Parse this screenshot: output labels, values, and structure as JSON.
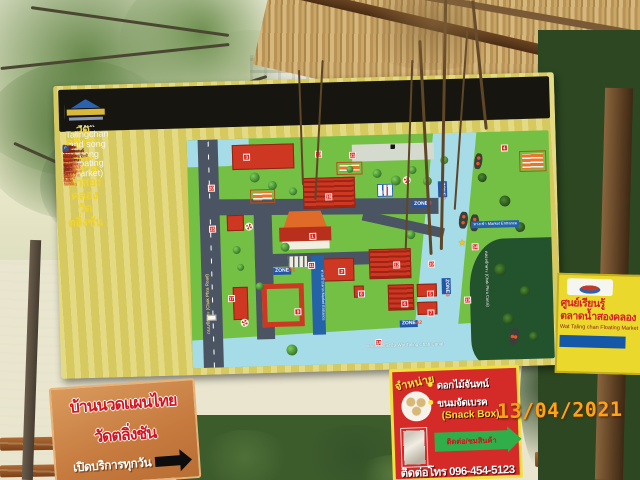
{
  "header": {
    "title_thai": "แผนผังวัดตลิ่งชัน และตลาดน้ำสองคลองวัดตลิ่งชัน",
    "title_en": "(Map of Wat Talingchan and song Klong Floating Market)"
  },
  "legend": {
    "items": [
      {
        "icon": "num",
        "num": "1",
        "thai": "พระอุโบสถ",
        "en": "(Ubosot Hall)"
      },
      {
        "icon": "num",
        "num": "2",
        "thai": "ศาลาเอนกประสงค์เฉลิมพระเกียรติ ๘๔ พรรษา",
        "en": "(Multi-purpose Pavilion)"
      },
      {
        "icon": "num",
        "num": "3",
        "thai": "สระน้ำ",
        "en": "(Pond)"
      },
      {
        "icon": "num",
        "num": "4",
        "thai": "ศาลาราย",
        "en": "(Side Pavilion)"
      },
      {
        "icon": "num",
        "num": "5",
        "thai": "หอระฆัง",
        "en": "(Bell Tower)"
      },
      {
        "icon": "num",
        "num": "6",
        "thai": "หอสวดมนต์และหอฉัน",
        "en": "(Prayer Hall)"
      },
      {
        "icon": "num",
        "num": "7",
        "thai": "กุฏิสงฆ์-เขตสังฆาวาส",
        "en": "(Monk Quarters)"
      },
      {
        "icon": "num",
        "num": "8",
        "thai": "ศาลาบำเพ็ญกุศลและเมรุ",
        "en": "(Funeral Pavilion and Crematorium)"
      },
      {
        "icon": "num",
        "num": "9",
        "thai": "ตลาดน้ำวัดตลิ่งชัน",
        "en": "(Wat Talingchan Floating Market)"
      },
      {
        "icon": "num",
        "num": "10",
        "thai": "กุฏิเจ้าอาวาสและสำนักงาน",
        "en": "(Abbot Quarters and Office)"
      },
      {
        "icon": "num",
        "num": "11",
        "thai": "โรงเรียนพระปริยัติธรรม",
        "en": "(Dhamma School)"
      },
      {
        "icon": "num",
        "num": "12",
        "thai": "ศาลาท่าน้ำและเวทีดนตรี",
        "en": "(Waterfront Pavilion and Music Stage)"
      },
      {
        "icon": "num",
        "num": "13",
        "thai": "สวนสุขภาพและเครื่องเล่นเด็ก",
        "en": "(Health Park and Playground)"
      },
      {
        "icon": "num",
        "num": "14",
        "thai": "หอถังประปา",
        "en": "(Water Tower)"
      },
      {
        "icon": "num",
        "num": "15",
        "thai": "ศาลาอเนกประสงค์ริมคลอง 1, 2 และ 3",
        "en": "(Riverside Pavilions 1, 2 and 3)"
      },
      {
        "icon": "num",
        "num": "16",
        "thai": "เรือนเพาะชำ",
        "en": "(Plant Nursery)"
      },
      {
        "icon": "num",
        "num": "17",
        "thai": "บ้านสวนริมน้ำ-ตลาดเรือโบราณ",
        "en": "(Riverside Boat House Market)"
      },
      {
        "icon": "num",
        "num": "18",
        "thai": "ศาลาประชาคม ลานกิจกรรม",
        "en": "(Community Hall and Activity Yard)"
      },
      {
        "icon": "num",
        "num": "19",
        "thai": "ศาลาน้ำผึ้งและท่าเรือนำเที่ยว",
        "en": "(Pier for Tour Boats)"
      },
      {
        "icon": "star",
        "num": "★",
        "thai": "จุดชมวิว-จุดนัดพบ",
        "en": "(Tourist Meeting Point)"
      },
      {
        "icon": "num",
        "num": "20",
        "thai": "แผงขายสินค้าและของที่ระลึก",
        "en": "(Souvenir Stalls)"
      },
      {
        "icon": "num",
        "num": "21",
        "thai": "อุทยานผักสวนครัวลอยน้ำตลาดเรือโบราณ",
        "en": "(Floating Market Gardens)"
      },
      {
        "icon": "toilet",
        "num": "WC",
        "thai": "สุขา ชาย-หญิง คนพิการ และผู้สูงอายุ",
        "en": "(Toilet)"
      },
      {
        "icon": "p",
        "num": "P",
        "thai": "ลานจอดรถยนต์",
        "en": "(Car Parking)"
      },
      {
        "icon": "p",
        "num": "P",
        "thai": "ที่จอดรถจักรยานยนต์",
        "en": "(Motorcycle Parking)"
      }
    ]
  },
  "map": {
    "zones": [
      {
        "zone": "ZONE",
        "letter": "A1"
      },
      {
        "zone": "ZONE",
        "letter": "A2"
      },
      {
        "zone": "ZONE",
        "letter": "B"
      },
      {
        "zone": "ZONE",
        "letter": "C"
      },
      {
        "zone": "ZONE",
        "letter": "D"
      }
    ],
    "markers": [
      1,
      2,
      3,
      4,
      5,
      6,
      7,
      8,
      9,
      10,
      11,
      12,
      13,
      14,
      15,
      16,
      17,
      18,
      19,
      20,
      21
    ],
    "labels": {
      "road": "ถนนชักพระ (Chak Phra Road)",
      "canal_bottom": "คลองวัดตลิ่งชัน Wat Taling Chan Canal",
      "canal_right": "คลองชักพระ (Chak Phra Canal)",
      "entrance": "ทางเข้า Market Entrance",
      "walkway": "ทางเข้าตลาด Market Entrance"
    }
  },
  "signs": {
    "massage": {
      "line1": "บ้านนวดแผนไทย",
      "line2": "วัดตลิ่งชัน",
      "line3": "เปิดบริการทุกวัน"
    },
    "snack": {
      "corner": "จำหน่าย",
      "item1": "ดอกไม้จันทน์",
      "item2": "ขนมจัดเบรค",
      "item3": "(Snack Box)",
      "arrow": "ติดต่อ/ชมสินค้า",
      "phone": "ติดต่อโทร 096-454-5123"
    },
    "learning": {
      "line1": "ศูนย์เรียนรู้",
      "line2": "ตลาดน้ำสองคลอง",
      "line3": "Wat Taling chan Floating Market"
    }
  },
  "stamp": {
    "date": "13/04/2021"
  }
}
